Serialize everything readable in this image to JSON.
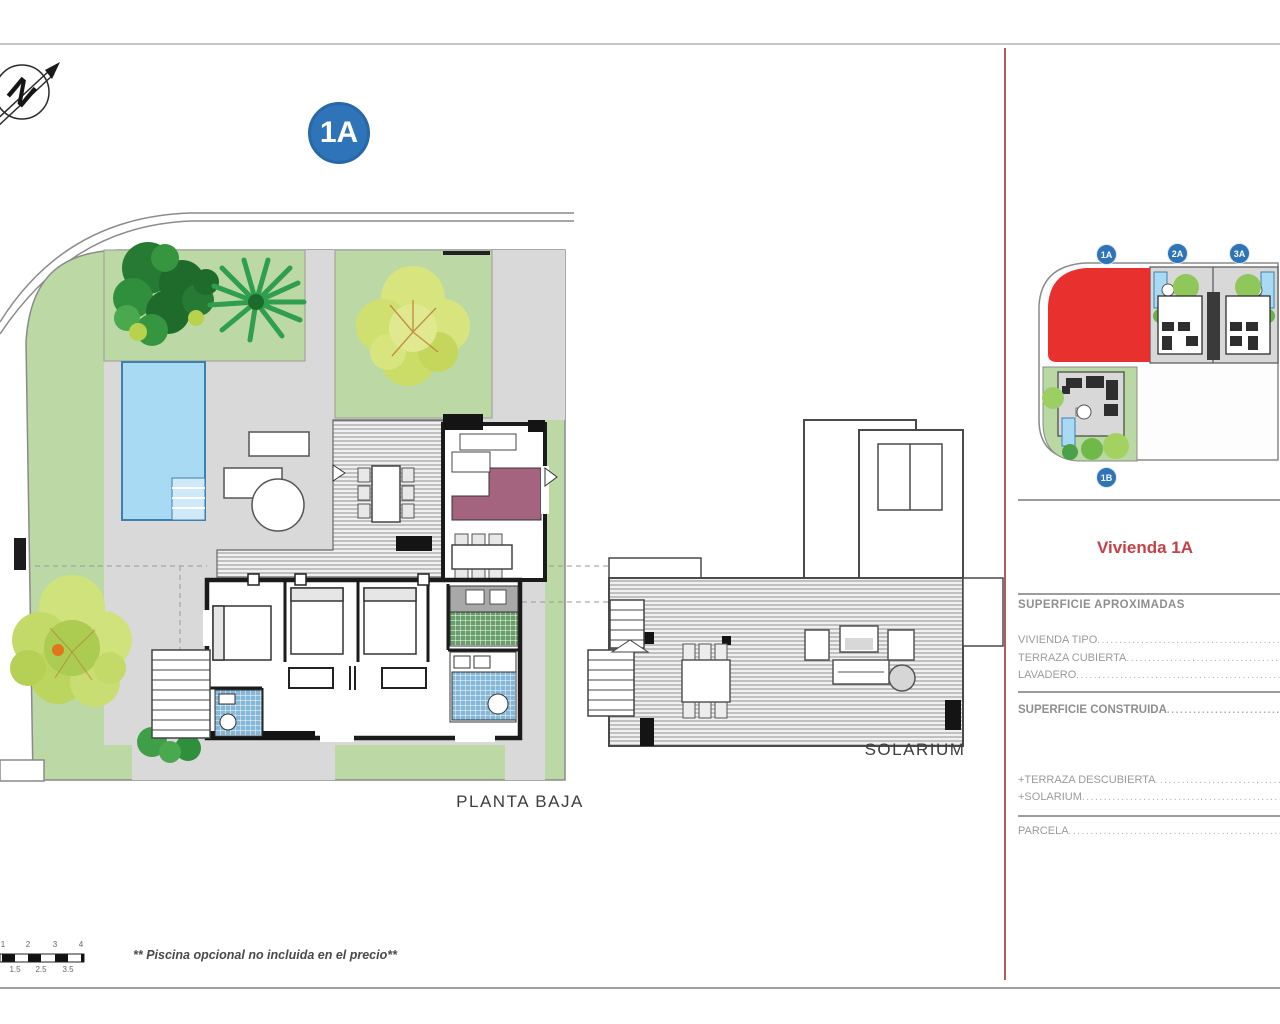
{
  "page": {
    "badge": "1A"
  },
  "compass": {
    "letter": "N"
  },
  "ground_floor": {
    "label": "PLANTA BAJA",
    "footnote": "** Piscina opcional no incluida en el precio**"
  },
  "solarium": {
    "label": "SOLARIUM"
  },
  "site_plan": {
    "units": [
      {
        "id": "1A",
        "highlighted": true
      },
      {
        "id": "2A",
        "highlighted": false
      },
      {
        "id": "3A",
        "highlighted": false
      },
      {
        "id": "1B",
        "highlighted": false
      }
    ]
  },
  "panel": {
    "title": "Vivienda 1A",
    "header_approx": "SUPERFICIE APROXIMADAS",
    "rows": {
      "vivienda_tipo": "VIVIENDA TIPO",
      "terraza_cubierta": "TERRAZA CUBIERTA",
      "lavadero": "LAVADERO",
      "superficie_construida": "SUPERFICIE CONSTRUIDA",
      "terraza_descubierta": "+TERRAZA DESCUBIERTA",
      "solarium": "+SOLARIUM",
      "parcela": "PARCELA"
    }
  },
  "scale_bar": {
    "top_labels": [
      "1",
      "2",
      "3",
      "4"
    ],
    "bottom_labels": [
      "1.5",
      "2.5",
      "3.5"
    ]
  },
  "colors": {
    "badge_blue": "#2f73b8",
    "title_red": "#c84046",
    "highlight_red": "#e8302e",
    "garden_green": "#bcd9a5",
    "pool_blue": "#a9daf3",
    "patio_gray": "#d9d9d9",
    "divider_red": "#b25b5b",
    "sofa_purple": "#a4647f"
  }
}
